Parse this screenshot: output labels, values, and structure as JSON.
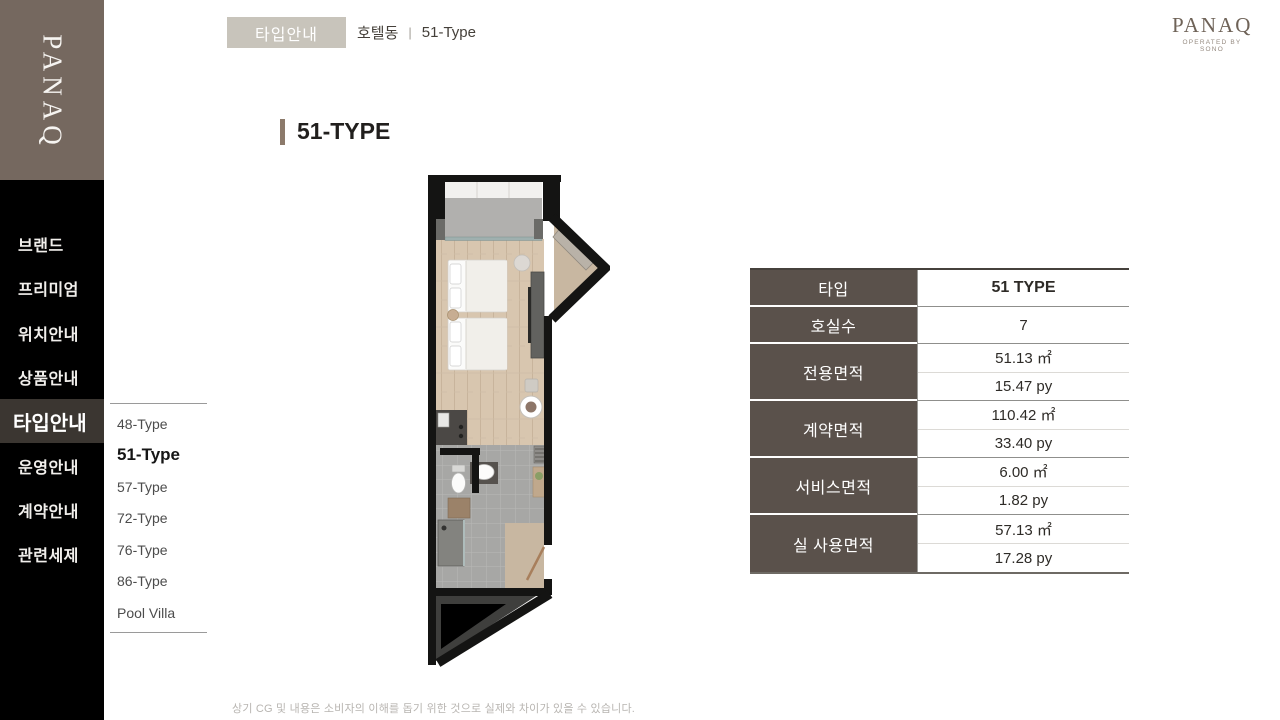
{
  "brand": {
    "sidebar_logo": "PANAQ",
    "header_logo": "PANAQ",
    "header_logo_tagline": "OPERATED BY SONO"
  },
  "header": {
    "badge": "타입안내",
    "breadcrumb_section": "호텔동",
    "breadcrumb_separator": "|",
    "breadcrumb_current": "51-Type"
  },
  "sidebar": {
    "items": [
      {
        "label": "브랜드",
        "active": false
      },
      {
        "label": "프리미엄",
        "active": false
      },
      {
        "label": "위치안내",
        "active": false
      },
      {
        "label": "상품안내",
        "active": false
      },
      {
        "label": "타입안내",
        "active": true
      },
      {
        "label": "운영안내",
        "active": false
      },
      {
        "label": "계약안내",
        "active": false
      },
      {
        "label": "관련세제",
        "active": false
      }
    ]
  },
  "submenu": {
    "items": [
      {
        "label": "48-Type",
        "active": false
      },
      {
        "label": "51-Type",
        "active": true
      },
      {
        "label": "57-Type",
        "active": false
      },
      {
        "label": "72-Type",
        "active": false
      },
      {
        "label": "76-Type",
        "active": false
      },
      {
        "label": "86-Type",
        "active": false
      },
      {
        "label": "Pool Villa",
        "active": false
      }
    ]
  },
  "main": {
    "title": "51-TYPE",
    "floorplan_name": "51-type-floor-plan"
  },
  "spec_table": {
    "rows": [
      {
        "label": "타입",
        "values": [
          "51 TYPE"
        ]
      },
      {
        "label": "호실수",
        "values": [
          "7"
        ]
      },
      {
        "label": "전용면적",
        "values": [
          "51.13 ㎡",
          "15.47 py"
        ]
      },
      {
        "label": "계약면적",
        "values": [
          "110.42 ㎡",
          "33.40 py"
        ]
      },
      {
        "label": "서비스면적",
        "values": [
          "6.00 ㎡",
          "1.82 py"
        ]
      },
      {
        "label": "실 사용면적",
        "values": [
          "57.13 ㎡",
          "17.28 py"
        ]
      }
    ]
  },
  "footer": {
    "disclaimer": "상기 CG 및 내용은 소비자의 이해를 돕기 위한 것으로 실제와 차이가 있을 수 있습니다."
  },
  "colors": {
    "sidebar_bg": "#000000",
    "logo_block_bg": "#75685f",
    "active_menu_bg": "#3b3631",
    "badge_bg": "#c8c4bb",
    "table_label_bg": "#5a514b",
    "title_bar": "#8c7a6b",
    "disclaimer_text": "#b8b5b1"
  }
}
